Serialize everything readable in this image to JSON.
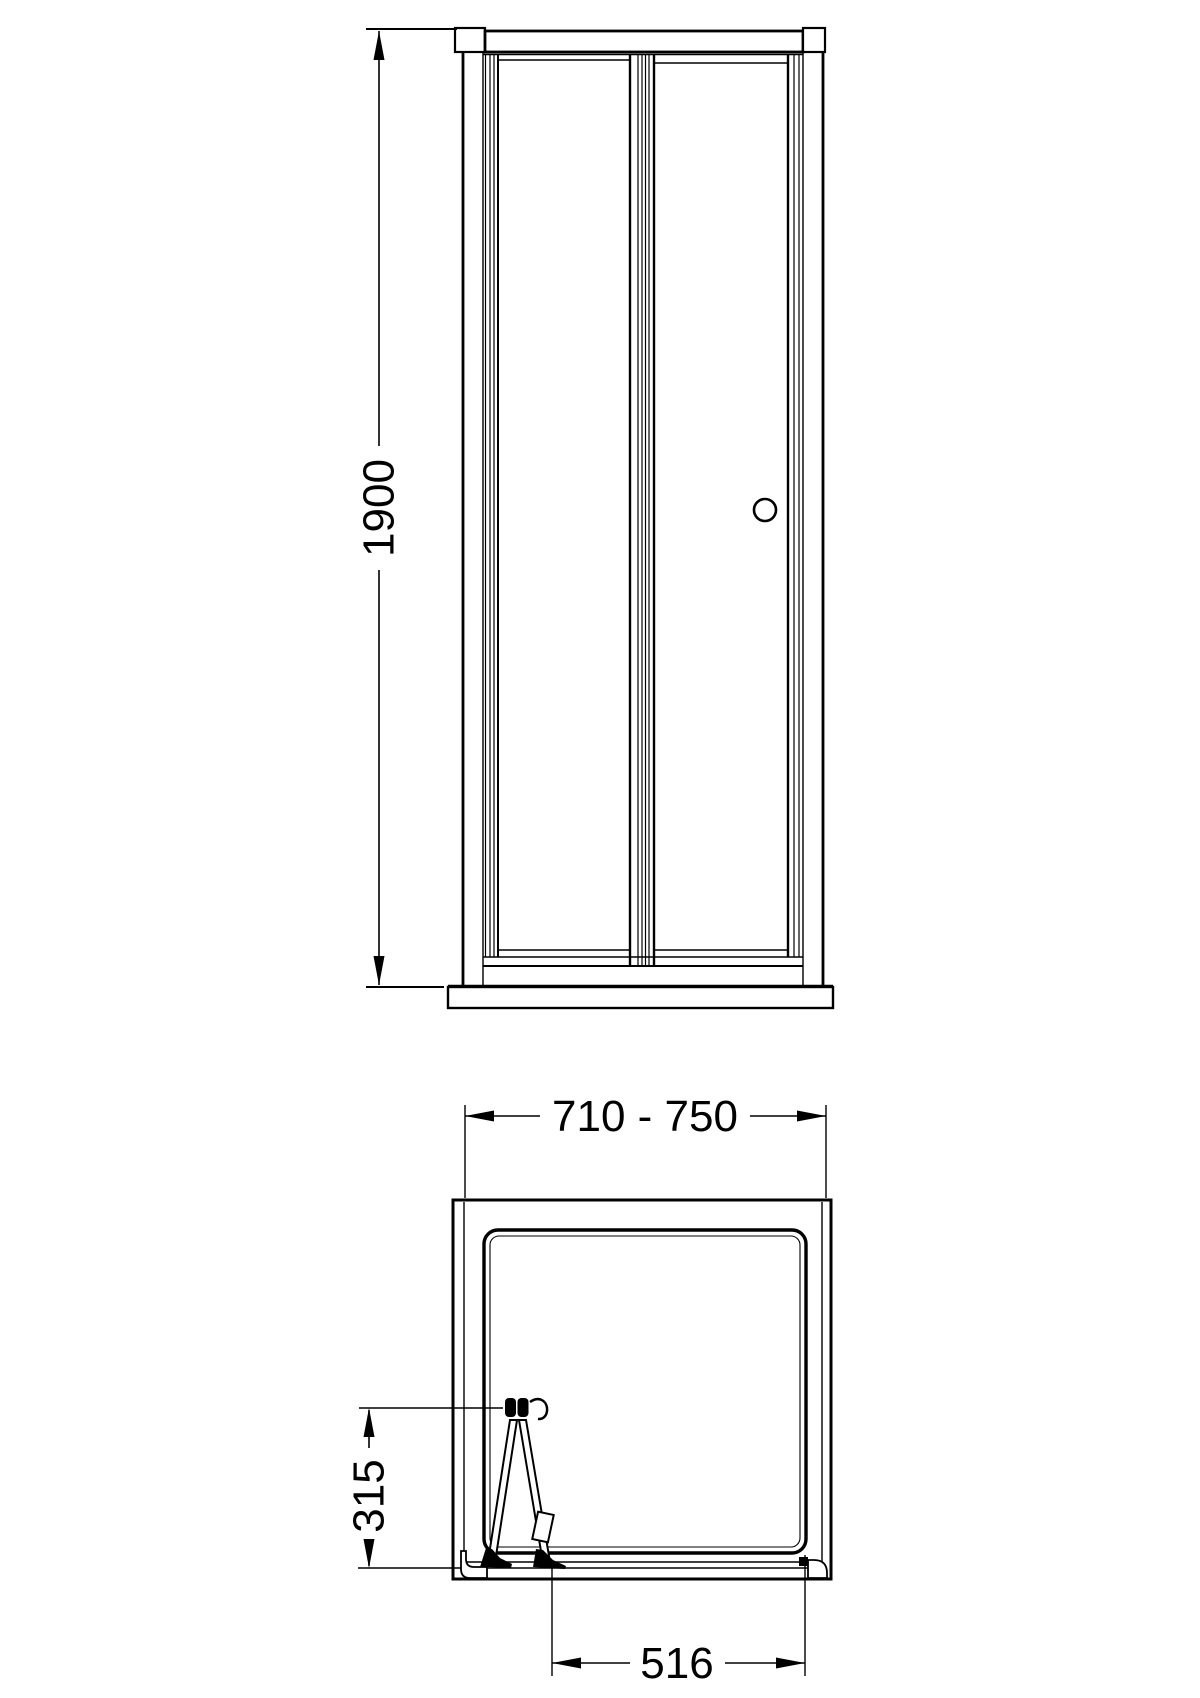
{
  "sheet": {
    "background": "#ffffff",
    "line_color": "#000000"
  },
  "views": {
    "front_elevation": {
      "dimensions": {
        "height": {
          "value": "1900"
        }
      }
    },
    "plan": {
      "dimensions": {
        "overall_width": {
          "value": "710 - 750"
        },
        "door_projection": {
          "value": "315"
        },
        "clear_opening": {
          "value": "516"
        }
      }
    }
  }
}
